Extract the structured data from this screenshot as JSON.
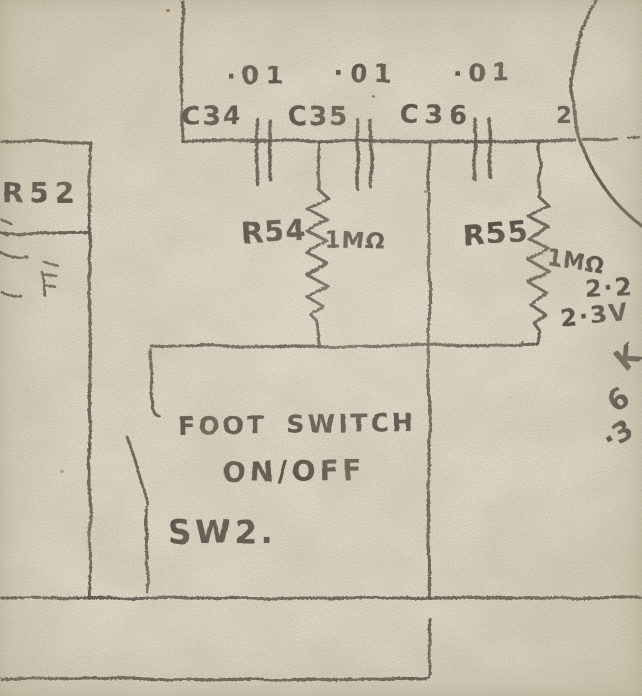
{
  "schematic": {
    "capacitors": [
      {
        "ref": "C34",
        "value": "·01"
      },
      {
        "ref": "C35",
        "value": "·01"
      },
      {
        "ref": "C36",
        "value": "·01"
      }
    ],
    "resistors": {
      "r52": {
        "ref": "R52"
      },
      "r54": {
        "ref": "R54",
        "value": "1MΩ"
      },
      "r55": {
        "ref": "R55",
        "value": "1MΩ"
      }
    },
    "valve": {
      "pin": "2"
    },
    "foot_switch": {
      "line1": "FOOT SWITCH",
      "line2": "ON/OFF",
      "ref": "SW2."
    },
    "annotations": {
      "voltage_1": "2·2",
      "voltage_2": "2·3V"
    },
    "edge_fragments": {
      "f1": "K",
      "f2": "6",
      "f3": "·3"
    }
  },
  "colors": {
    "paper": "#e8e1cf",
    "pencil": "#473f35"
  }
}
